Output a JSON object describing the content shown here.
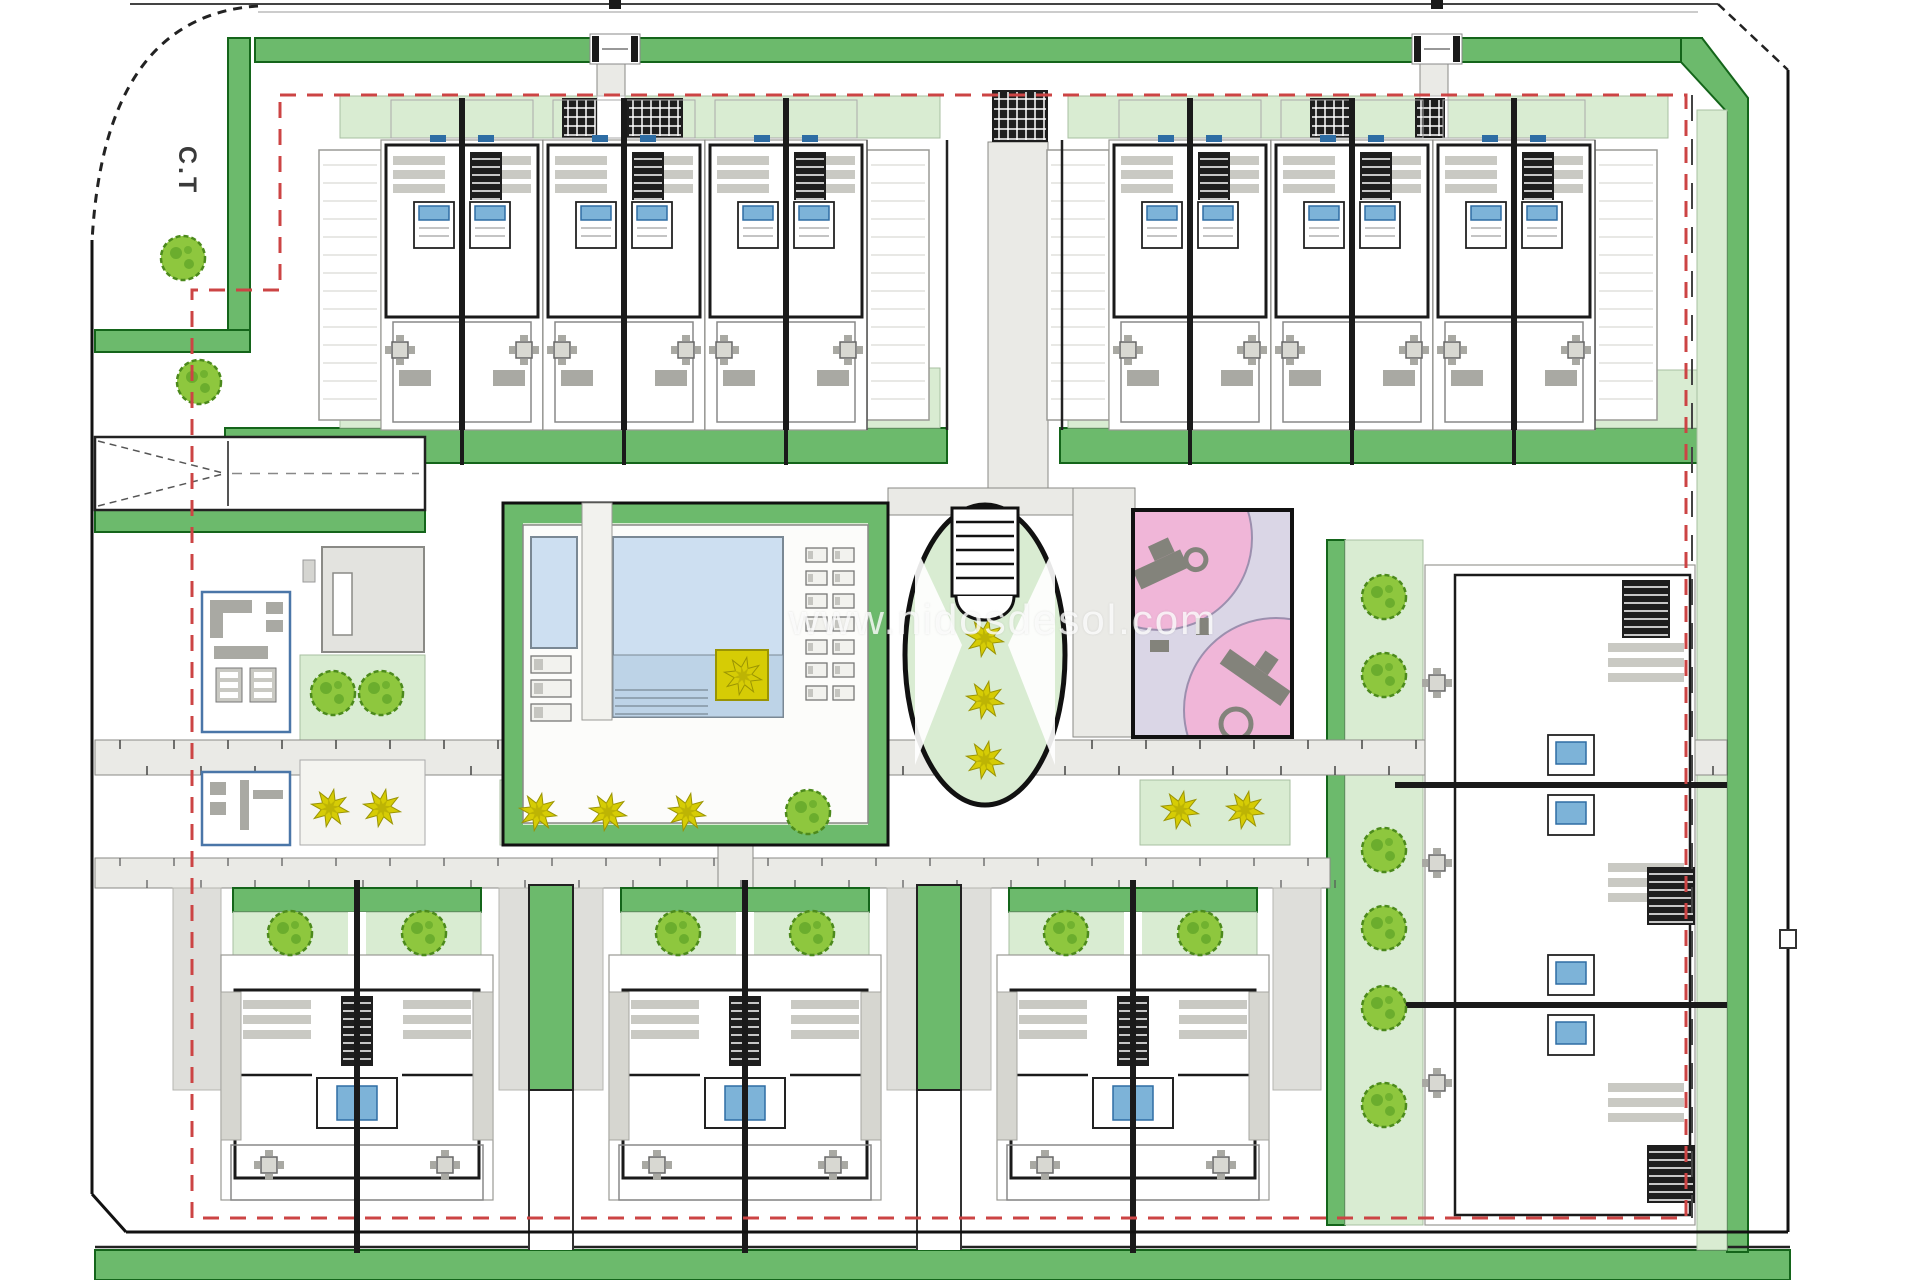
{
  "labels": {
    "corner_label": "C.T",
    "watermark": "www.nidosdesol.com"
  },
  "colors": {
    "green_med": "#6cba6c",
    "green_dark": "#14651a",
    "green_light": "#d9ecd2",
    "tree_fill": "#8ec73e",
    "tree_stroke": "#4c8a1c",
    "tree_blob": "#5da326",
    "yellow": "#d6cc05",
    "yellow_dark": "#9a9403",
    "pool_blue": "#cddff1",
    "pool_blue2": "#bdd3e7",
    "pool_edge": "#7a8894",
    "pink": "#f0b6d8",
    "lavender": "#dad6e6",
    "equip": "#83837b",
    "wall": "#1a1a1a",
    "furn": "#c9c9c3",
    "furn_dark": "#a9a9a3",
    "path_gray": "#eaeae6",
    "path_edge": "#8a8a86",
    "red": "#cc4444",
    "blue_accent": "#2e6da4",
    "bed_blue": "#7db3d8",
    "outline_gray": "#999994"
  },
  "plan": {
    "canvas": {
      "w": 1920,
      "h": 1280
    },
    "boundary": {
      "top": [
        130,
        4,
        1718,
        4
      ],
      "top2": [
        258,
        12,
        1698,
        12
      ],
      "right": [
        1788,
        70,
        1788,
        1232
      ],
      "bottom": [
        126,
        1232,
        1788,
        1232
      ],
      "left": [
        92,
        240,
        92,
        1194
      ],
      "bl_diag": [
        92,
        1194,
        126,
        1232
      ],
      "tr_diag": [
        1718,
        4,
        1788,
        70
      ],
      "tl_curve": "M258,6 Q104,16 92,242",
      "notch": [
        1780,
        930,
        16,
        18
      ]
    },
    "red_boundary": {
      "path": "M280,95 H1686 V1218 H192 V290 H280 V95",
      "overlay_line": [
        1692,
        95,
        1692,
        1218
      ]
    },
    "green_bands": [
      [
        255,
        38,
        1447,
        24
      ],
      [
        228,
        38,
        22,
        312
      ],
      [
        95,
        330,
        155,
        22
      ],
      [
        225,
        428,
        722,
        35
      ],
      [
        1060,
        428,
        667,
        35
      ],
      [
        95,
        510,
        330,
        22
      ],
      [
        1327,
        540,
        18,
        685
      ],
      [
        95,
        1250,
        1695,
        30
      ]
    ],
    "right_band_poly": "M1681,38 L1702,38 L1748,98 L1748,1252 L1727,1252 L1727,112 L1681,62 Z",
    "light_green": [
      [
        340,
        96,
        600,
        42
      ],
      [
        1068,
        96,
        600,
        42
      ],
      [
        340,
        368,
        600,
        60
      ],
      [
        1068,
        370,
        629,
        58
      ],
      [
        300,
        655,
        125,
        85
      ],
      [
        500,
        780,
        362,
        65
      ],
      [
        1140,
        780,
        150,
        65
      ],
      [
        1345,
        540,
        78,
        685
      ],
      [
        1697,
        110,
        30,
        1140
      ]
    ],
    "walkways": [
      [
        95,
        740,
        1632,
        35
      ],
      [
        95,
        858,
        1235,
        30
      ],
      [
        988,
        142,
        60,
        368
      ],
      [
        888,
        488,
        247,
        27
      ],
      [
        1073,
        488,
        62,
        249
      ],
      [
        718,
        845,
        35,
        43
      ],
      [
        597,
        62,
        28,
        34
      ],
      [
        1420,
        62,
        28,
        34
      ]
    ],
    "white_strips": [
      [
        529,
        1090,
        44,
        160
      ],
      [
        917,
        1090,
        44,
        160
      ]
    ],
    "gray_strips": [
      [
        173,
        888,
        48,
        202
      ],
      [
        499,
        888,
        30,
        202
      ],
      [
        573,
        888,
        30,
        202
      ],
      [
        887,
        888,
        30,
        202
      ],
      [
        961,
        888,
        30,
        202
      ],
      [
        1273,
        888,
        48,
        202
      ]
    ],
    "strip_greens": [
      [
        529,
        885,
        44,
        205
      ],
      [
        917,
        885,
        44,
        205
      ]
    ],
    "gates": [
      [
        590,
        640
      ],
      [
        1412,
        1462
      ]
    ],
    "top_units": {
      "y": 140,
      "h": 290,
      "w": 162,
      "lefts": [
        381,
        543,
        705,
        1109,
        1271,
        1433
      ],
      "patio_gaps": [
        [
          597,
          625
        ],
        [
          1420,
          1448
        ]
      ],
      "patio_hatches": [
        [
          562,
          597
        ],
        [
          627,
          683
        ],
        [
          1310,
          1355
        ],
        [
          1415,
          1445
        ]
      ],
      "terraces": [
        [
          319,
          381
        ],
        [
          867,
          929
        ],
        [
          1047,
          1109
        ],
        [
          1595,
          1657
        ]
      ],
      "gap": {
        "x": [
          947,
          1062
        ],
        "hatch": [
          992,
          90,
          56,
          52
        ]
      }
    },
    "bottom_units": {
      "centers": [
        357,
        745,
        1133
      ],
      "width": 272,
      "header_y": 888,
      "garden_y": 912,
      "body_top": 955,
      "body_bottom": 1200
    },
    "right_units": {
      "x1": 1425,
      "x2": 1695,
      "party_y": [
        785,
        1005
      ],
      "top": 565,
      "bottom": 1225,
      "stair_hatches": [
        [
          1647,
          867
        ],
        [
          1647,
          1145
        ],
        [
          1622,
          580
        ]
      ],
      "tables": [
        [
          1437,
          683
        ],
        [
          1437,
          863
        ],
        [
          1437,
          1083
        ]
      ]
    },
    "pool": {
      "outer": [
        503,
        503,
        385,
        342
      ],
      "deck": [
        523,
        525,
        345,
        298
      ],
      "small": [
        531,
        537,
        46,
        111
      ],
      "main": [
        613,
        537,
        170,
        180
      ],
      "divider_walk": [
        582,
        503,
        30,
        217
      ],
      "steps_y": [
        690,
        698,
        706,
        714
      ],
      "loungers_right": {
        "x": 806,
        "y": 548,
        "cols": 2,
        "rows": 7,
        "dx": 27,
        "dy": 23
      },
      "loungers_bottom": {
        "x": 531,
        "y": 656,
        "rows": 3,
        "dy": 24,
        "w": 40,
        "h": 17
      },
      "planter": [
        716,
        650,
        52,
        50
      ]
    },
    "oval": {
      "cx": 985,
      "cy": 655,
      "rx": 80,
      "ry": 150,
      "stair": [
        952,
        508,
        66,
        88
      ]
    },
    "playground": {
      "rect": [
        1133,
        510,
        159,
        227
      ],
      "circles": [
        [
          1160,
          538,
          92
        ],
        [
          1276,
          710,
          92
        ]
      ]
    },
    "offices": {
      "road": [
        95,
        437,
        330,
        73
      ],
      "gray_building": [
        322,
        547,
        102,
        105
      ],
      "door": [
        333,
        573,
        19,
        62
      ],
      "office_top": [
        202,
        592,
        88,
        140
      ],
      "office_bottom": [
        202,
        772,
        88,
        73
      ],
      "plant_strip": [
        300,
        760,
        125,
        85
      ]
    },
    "vegetation": {
      "tree_radius": 22,
      "trees": [
        [
          183,
          258
        ],
        [
          199,
          382
        ],
        [
          333,
          693
        ],
        [
          381,
          693
        ],
        [
          290,
          933
        ],
        [
          424,
          933
        ],
        [
          678,
          933
        ],
        [
          812,
          933
        ],
        [
          1066,
          933
        ],
        [
          1200,
          933
        ],
        [
          808,
          812
        ],
        [
          1384,
          597
        ],
        [
          1384,
          675
        ],
        [
          1384,
          850
        ],
        [
          1384,
          928
        ],
        [
          1384,
          1008
        ],
        [
          1384,
          1105
        ]
      ],
      "yellow_plants": [
        [
          330,
          808
        ],
        [
          382,
          808
        ],
        [
          538,
          812
        ],
        [
          608,
          812
        ],
        [
          687,
          812
        ],
        [
          1180,
          810
        ],
        [
          1245,
          810
        ],
        [
          985,
          638
        ],
        [
          985,
          700
        ],
        [
          985,
          760
        ],
        [
          743,
          676
        ]
      ]
    }
  }
}
